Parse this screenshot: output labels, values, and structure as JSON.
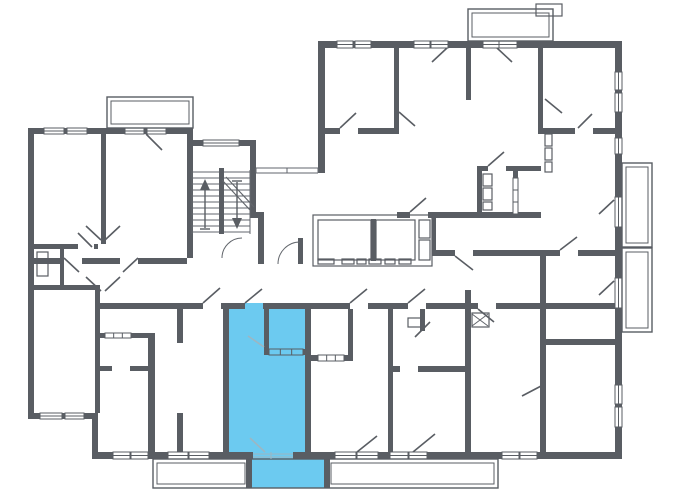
{
  "meta": {
    "type": "floor-plan"
  },
  "canvas": {
    "width": 680,
    "height": 500
  },
  "colors": {
    "background": "#ffffff",
    "wall": "#595d63",
    "line": "#62666c",
    "light_line": "#9db6c2",
    "highlight": "#6ccaf0"
  },
  "floorplan": {
    "walls": [
      [
        28,
        128,
        6,
        291
      ],
      [
        28,
        128,
        165,
        6
      ],
      [
        187,
        134,
        6,
        124
      ],
      [
        187,
        140,
        69,
        6
      ],
      [
        250,
        146,
        6,
        66
      ],
      [
        250,
        212,
        14,
        6
      ],
      [
        258,
        212,
        6,
        52
      ],
      [
        318,
        41,
        7,
        132
      ],
      [
        318,
        41,
        304,
        7
      ],
      [
        615,
        41,
        7,
        417
      ],
      [
        92,
        452,
        530,
        7
      ],
      [
        92,
        413,
        6,
        45
      ],
      [
        28,
        413,
        70,
        6
      ],
      [
        101,
        134,
        5,
        110
      ],
      [
        34,
        244,
        44,
        5
      ],
      [
        94,
        244,
        4,
        5
      ],
      [
        34,
        285,
        64,
        5
      ],
      [
        60,
        249,
        4,
        36
      ],
      [
        95,
        285,
        5,
        128
      ],
      [
        95,
        303,
        108,
        6
      ],
      [
        221,
        303,
        24,
        6
      ],
      [
        263,
        303,
        50,
        6
      ],
      [
        223,
        309,
        6,
        143
      ],
      [
        305,
        309,
        6,
        143
      ],
      [
        264,
        309,
        5,
        40
      ],
      [
        264,
        349,
        44,
        6
      ],
      [
        148,
        333,
        7,
        119
      ],
      [
        95,
        333,
        58,
        5
      ],
      [
        95,
        366,
        17,
        5
      ],
      [
        130,
        366,
        23,
        5
      ],
      [
        177,
        303,
        6,
        40
      ],
      [
        177,
        413,
        6,
        39
      ],
      [
        388,
        309,
        5,
        143
      ],
      [
        465,
        290,
        6,
        162
      ],
      [
        393,
        366,
        7,
        6
      ],
      [
        418,
        366,
        47,
        6
      ],
      [
        420,
        309,
        5,
        22
      ],
      [
        348,
        309,
        5,
        52
      ],
      [
        311,
        355,
        42,
        6
      ],
      [
        540,
        339,
        82,
        6
      ],
      [
        540,
        345,
        6,
        107
      ],
      [
        540,
        256,
        6,
        83
      ],
      [
        432,
        250,
        23,
        6
      ],
      [
        473,
        250,
        87,
        6
      ],
      [
        578,
        250,
        39,
        6
      ],
      [
        313,
        303,
        37,
        6
      ],
      [
        368,
        303,
        40,
        6
      ],
      [
        426,
        303,
        52,
        6
      ],
      [
        496,
        303,
        121,
        6
      ],
      [
        394,
        48,
        5,
        86
      ],
      [
        318,
        128,
        22,
        6
      ],
      [
        358,
        128,
        39,
        6
      ],
      [
        466,
        48,
        5,
        52
      ],
      [
        538,
        48,
        5,
        83
      ],
      [
        538,
        128,
        37,
        6
      ],
      [
        593,
        128,
        29,
        6
      ],
      [
        477,
        166,
        11,
        5
      ],
      [
        506,
        166,
        35,
        5
      ],
      [
        477,
        166,
        5,
        51
      ],
      [
        513,
        171,
        5,
        46
      ],
      [
        397,
        212,
        13,
        6
      ],
      [
        428,
        212,
        113,
        6
      ],
      [
        432,
        218,
        4,
        32
      ],
      [
        34,
        258,
        30,
        6
      ],
      [
        82,
        258,
        38,
        6
      ],
      [
        138,
        258,
        49,
        6
      ],
      [
        298,
        238,
        5,
        26
      ],
      [
        371,
        219,
        5,
        42
      ],
      [
        246,
        459,
        6,
        29
      ],
      [
        324,
        459,
        6,
        29
      ]
    ],
    "windows": [
      [
        44,
        128,
        20,
        6
      ],
      [
        67,
        128,
        20,
        6
      ],
      [
        125,
        128,
        19,
        6
      ],
      [
        147,
        128,
        19,
        6
      ],
      [
        40,
        413,
        22,
        6
      ],
      [
        65,
        413,
        19,
        6
      ],
      [
        203,
        140,
        36,
        6
      ],
      [
        337,
        41,
        16,
        7
      ],
      [
        355,
        41,
        16,
        7
      ],
      [
        414,
        41,
        16,
        7
      ],
      [
        431,
        41,
        17,
        7
      ],
      [
        483,
        41,
        16,
        7
      ],
      [
        499,
        41,
        18,
        7
      ],
      [
        113,
        452,
        17,
        7
      ],
      [
        131,
        452,
        17,
        7
      ],
      [
        168,
        452,
        20,
        7
      ],
      [
        189,
        452,
        20,
        7
      ],
      [
        335,
        452,
        21,
        7
      ],
      [
        357,
        452,
        21,
        7
      ],
      [
        390,
        452,
        18,
        7
      ],
      [
        409,
        452,
        18,
        7
      ],
      [
        502,
        452,
        17,
        7
      ],
      [
        520,
        452,
        17,
        7
      ],
      [
        615,
        72,
        7,
        18
      ],
      [
        615,
        93,
        7,
        19
      ],
      [
        615,
        138,
        7,
        16
      ],
      [
        615,
        197,
        7,
        30
      ],
      [
        615,
        278,
        7,
        30
      ],
      [
        615,
        385,
        7,
        19
      ],
      [
        615,
        407,
        7,
        20
      ]
    ],
    "interior_windows": [
      [
        105,
        333,
        26,
        5,
        0
      ],
      [
        318,
        355,
        26,
        6,
        0
      ],
      [
        269,
        349,
        34,
        6,
        1
      ],
      [
        513,
        178,
        5,
        36,
        0
      ]
    ],
    "doors": [
      [
        146,
        134,
        162,
        150
      ],
      [
        86,
        226,
        101,
        240
      ],
      [
        120,
        226,
        105,
        240
      ],
      [
        78,
        233,
        92,
        247
      ],
      [
        86,
        277,
        101,
        291
      ],
      [
        120,
        277,
        105,
        291
      ],
      [
        64,
        258,
        79,
        272
      ],
      [
        138,
        258,
        123,
        272
      ],
      [
        203,
        303,
        220,
        288
      ],
      [
        245,
        303,
        262,
        289
      ],
      [
        350,
        303,
        367,
        289
      ],
      [
        408,
        303,
        425,
        289
      ],
      [
        478,
        309,
        494,
        322
      ],
      [
        455,
        256,
        473,
        270
      ],
      [
        560,
        250,
        577,
        237
      ],
      [
        340,
        128,
        356,
        113
      ],
      [
        399,
        112,
        415,
        126
      ],
      [
        447,
        48,
        432,
        62
      ],
      [
        497,
        48,
        512,
        62
      ],
      [
        578,
        128,
        592,
        114
      ],
      [
        545,
        99,
        562,
        113
      ],
      [
        488,
        166,
        504,
        152
      ],
      [
        410,
        212,
        426,
        198
      ],
      [
        430,
        322,
        415,
        337
      ],
      [
        614,
        200,
        599,
        214
      ],
      [
        614,
        281,
        599,
        295
      ],
      [
        522,
        396,
        543,
        385
      ],
      [
        357,
        452,
        377,
        436
      ],
      [
        413,
        452,
        435,
        434
      ],
      [
        250,
        438,
        265,
        452,
        1
      ],
      [
        264,
        347,
        248,
        336,
        1
      ]
    ],
    "arcs": [
      "M222,258 A20,20 0 0 1 242,238",
      "M278,264 A22,22 0 0 1 300,242"
    ],
    "balconies": {
      "outer": [
        [
          107,
          97,
          86,
          31
        ],
        [
          468,
          9,
          85,
          32
        ],
        [
          622,
          163,
          30,
          84
        ],
        [
          622,
          248,
          30,
          84
        ],
        [
          153,
          459,
          345,
          29
        ]
      ],
      "inner": [
        [
          111,
          101,
          78,
          23
        ],
        [
          472,
          13,
          77,
          24
        ],
        [
          626,
          167,
          22,
          76
        ],
        [
          626,
          252,
          22,
          76
        ],
        [
          157,
          463,
          88,
          21
        ],
        [
          331,
          463,
          163,
          21
        ]
      ]
    },
    "fixtures": [
      [
        37,
        252,
        11,
        24
      ],
      [
        313,
        215,
        119,
        51
      ],
      [
        318,
        220,
        53,
        40
      ],
      [
        376,
        220,
        39,
        40
      ],
      [
        419,
        220,
        11,
        18
      ],
      [
        419,
        240,
        11,
        20
      ],
      [
        318,
        259,
        16,
        5
      ],
      [
        342,
        259,
        12,
        5
      ],
      [
        357,
        259,
        9,
        5
      ],
      [
        369,
        259,
        12,
        5
      ],
      [
        385,
        259,
        10,
        5
      ],
      [
        399,
        259,
        12,
        5
      ],
      [
        483,
        174,
        9,
        12
      ],
      [
        483,
        188,
        9,
        12
      ],
      [
        483,
        202,
        9,
        8
      ],
      [
        472,
        313,
        17,
        14
      ],
      [
        408,
        318,
        13,
        9
      ],
      [
        545,
        134,
        7,
        12
      ],
      [
        545,
        148,
        7,
        12
      ],
      [
        545,
        162,
        7,
        10
      ],
      [
        536,
        4,
        26,
        12
      ]
    ],
    "thin_lines": [
      [
        256,
        168,
        318,
        168
      ],
      [
        256,
        173,
        318,
        173
      ],
      [
        256,
        168,
        256,
        173
      ],
      [
        287,
        168,
        287,
        173
      ],
      [
        318,
        168,
        318,
        173
      ],
      [
        472,
        314,
        488,
        326
      ],
      [
        472,
        326,
        488,
        314
      ],
      [
        253,
        454,
        293,
        454,
        1
      ],
      [
        253,
        457,
        293,
        457,
        1
      ],
      [
        271,
        452,
        271,
        459,
        1
      ]
    ],
    "stairs": {
      "steps": {
        "x1": 192,
        "x2": 250,
        "y": 172,
        "count": 11,
        "gap": 6
      },
      "rails": [
        [
          192,
          170,
          192,
          234
        ],
        [
          250,
          170,
          250,
          234
        ]
      ],
      "divider": [
        219,
        168,
        5,
        66
      ],
      "break": [
        [
          222,
          180,
          250,
          210
        ],
        [
          226,
          177,
          254,
          207
        ]
      ],
      "arrows": [
        {
          "line": [
            205,
            228,
            205,
            184
          ],
          "head": [
            [
              200,
              190
            ],
            [
              205,
              179
            ],
            [
              210,
              190
            ]
          ],
          "base": [
            200,
            229,
            210,
            229
          ]
        },
        {
          "line": [
            237,
            182,
            237,
            224
          ],
          "head": [
            [
              232,
              218
            ],
            [
              237,
              229
            ],
            [
              242,
              218
            ]
          ],
          "base": [
            232,
            181,
            242,
            181
          ]
        }
      ]
    },
    "highlight": {
      "rooms": [
        [
          227,
          303,
          82,
          152
        ]
      ],
      "balcony": [
        [
          249,
          459,
          78,
          29
        ]
      ],
      "opening": [
        [
          253,
          452,
          40,
          7
        ]
      ]
    }
  }
}
